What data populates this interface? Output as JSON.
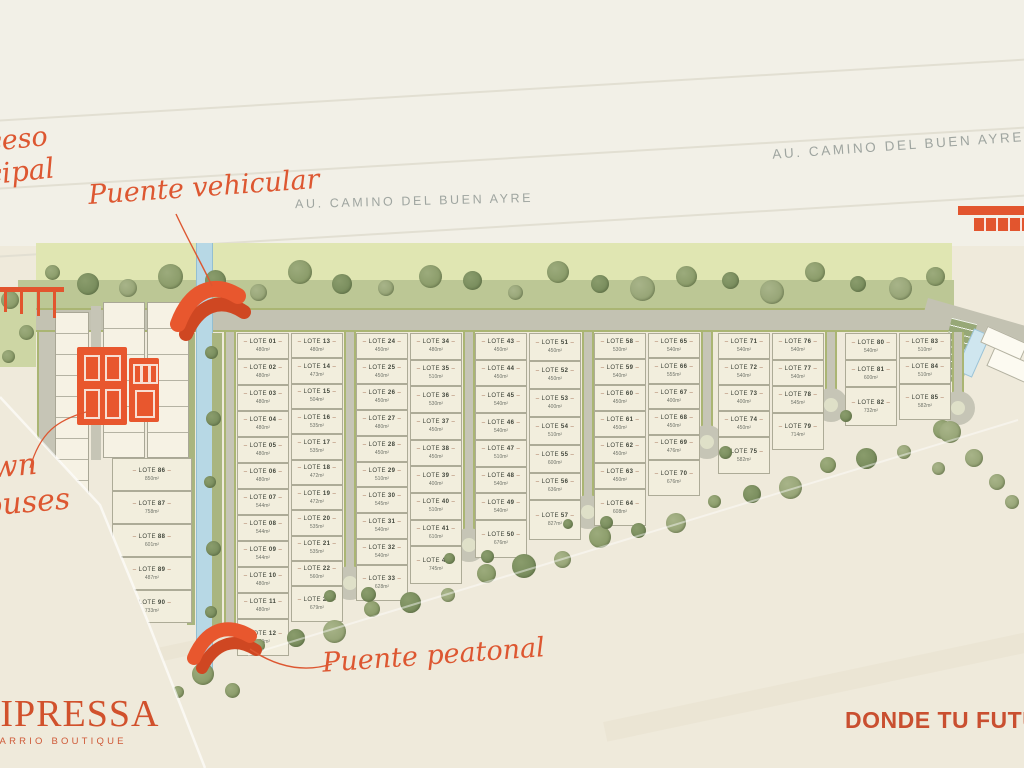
{
  "branding": {
    "logo": "CIPRESSA",
    "logo_subtitle": "BARRIO BOUTIQUE",
    "tagline": "DONDE TU FUTURO"
  },
  "labels": {
    "highway": "AU. CAMINO DEL BUEN AYRE",
    "access_line1": "Acceso",
    "access_line2": "principal",
    "vehicular_bridge": "Puente vehicular",
    "pedestrian_bridge": "Puente peatonal",
    "town_houses_line1": "town",
    "town_houses_line2": "houses"
  },
  "colors": {
    "accent_orange": "#E2552E",
    "script_orange": "#DD5731",
    "logo_orange": "#D1512C",
    "road_gray": "#C6C5B6",
    "buffer_green_light": "#E0E6B2",
    "buffer_green_dark": "#BCC795",
    "canal_blue": "#B7D8E5",
    "lot_fill": "#F2EEDD",
    "highway_text_gray": "#9FA5A0",
    "background_cream": "#EFEADB"
  },
  "lot_columns": [
    [
      {
        "id": "LOTE 01",
        "area": "480m²"
      },
      {
        "id": "LOTE 02",
        "area": "480m²"
      },
      {
        "id": "LOTE 03",
        "area": "480m²"
      },
      {
        "id": "LOTE 04",
        "area": "480m²"
      },
      {
        "id": "LOTE 05",
        "area": "480m²"
      },
      {
        "id": "LOTE 06",
        "area": "480m²"
      },
      {
        "id": "LOTE 07",
        "area": "544m²"
      },
      {
        "id": "LOTE 08",
        "area": "544m²"
      },
      {
        "id": "LOTE 09",
        "area": "544m²"
      },
      {
        "id": "LOTE 10",
        "area": "480m²"
      },
      {
        "id": "LOTE 11",
        "area": "480m²"
      },
      {
        "id": "LOTE 12",
        "area": "679m²"
      }
    ],
    [
      {
        "id": "LOTE 13",
        "area": "480m²"
      },
      {
        "id": "LOTE 14",
        "area": "473m²"
      },
      {
        "id": "LOTE 15",
        "area": "504m²"
      },
      {
        "id": "LOTE 16",
        "area": "535m²"
      },
      {
        "id": "LOTE 17",
        "area": "535m²"
      },
      {
        "id": "LOTE 18",
        "area": "472m²"
      },
      {
        "id": "LOTE 19",
        "area": "472m²"
      },
      {
        "id": "LOTE 20",
        "area": "535m²"
      },
      {
        "id": "LOTE 21",
        "area": "535m²"
      },
      {
        "id": "LOTE 22",
        "area": "560m²"
      },
      {
        "id": "LOTE 23",
        "area": "679m²"
      }
    ],
    [
      {
        "id": "LOTE 24",
        "area": "450m²"
      },
      {
        "id": "LOTE 25",
        "area": "450m²"
      },
      {
        "id": "LOTE 26",
        "area": "450m²"
      },
      {
        "id": "LOTE 27",
        "area": "480m²"
      },
      {
        "id": "LOTE 28",
        "area": "450m²"
      },
      {
        "id": "LOTE 29",
        "area": "510m²"
      },
      {
        "id": "LOTE 30",
        "area": "545m²"
      },
      {
        "id": "LOTE 31",
        "area": "540m²"
      },
      {
        "id": "LOTE 32",
        "area": "540m²"
      },
      {
        "id": "LOTE 33",
        "area": "628m²"
      }
    ],
    [
      {
        "id": "LOTE 34",
        "area": "480m²"
      },
      {
        "id": "LOTE 35",
        "area": "510m²"
      },
      {
        "id": "LOTE 36",
        "area": "530m²"
      },
      {
        "id": "LOTE 37",
        "area": "450m²"
      },
      {
        "id": "LOTE 38",
        "area": "450m²"
      },
      {
        "id": "LOTE 39",
        "area": "400m²"
      },
      {
        "id": "LOTE 40",
        "area": "510m²"
      },
      {
        "id": "LOTE 41",
        "area": "610m²"
      },
      {
        "id": "LOTE 42",
        "area": "745m²"
      }
    ],
    [
      {
        "id": "LOTE 43",
        "area": "450m²"
      },
      {
        "id": "LOTE 44",
        "area": "450m²"
      },
      {
        "id": "LOTE 45",
        "area": "540m²"
      },
      {
        "id": "LOTE 46",
        "area": "540m²"
      },
      {
        "id": "LOTE 47",
        "area": "510m²"
      },
      {
        "id": "LOTE 48",
        "area": "540m²"
      },
      {
        "id": "LOTE 49",
        "area": "540m²"
      },
      {
        "id": "LOTE 50",
        "area": "676m²"
      }
    ],
    [
      {
        "id": "LOTE 51",
        "area": "450m²"
      },
      {
        "id": "LOTE 52",
        "area": "450m²"
      },
      {
        "id": "LOTE 53",
        "area": "400m²"
      },
      {
        "id": "LOTE 54",
        "area": "510m²"
      },
      {
        "id": "LOTE 55",
        "area": "600m²"
      },
      {
        "id": "LOTE 56",
        "area": "636m²"
      },
      {
        "id": "LOTE 57",
        "area": "827m²"
      }
    ],
    [
      {
        "id": "LOTE 58",
        "area": "530m²"
      },
      {
        "id": "LOTE 59",
        "area": "540m²"
      },
      {
        "id": "LOTE 60",
        "area": "450m²"
      },
      {
        "id": "LOTE 61",
        "area": "450m²"
      },
      {
        "id": "LOTE 62",
        "area": "450m²"
      },
      {
        "id": "LOTE 63",
        "area": "450m²"
      },
      {
        "id": "LOTE 64",
        "area": "608m²"
      }
    ],
    [
      {
        "id": "LOTE 65",
        "area": "540m²"
      },
      {
        "id": "LOTE 66",
        "area": "555m²"
      },
      {
        "id": "LOTE 67",
        "area": "400m²"
      },
      {
        "id": "LOTE 68",
        "area": "450m²"
      },
      {
        "id": "LOTE 69",
        "area": "476m²"
      },
      {
        "id": "LOTE 70",
        "area": "676m²"
      }
    ],
    [
      {
        "id": "LOTE 71",
        "area": "540m²"
      },
      {
        "id": "LOTE 72",
        "area": "540m²"
      },
      {
        "id": "LOTE 73",
        "area": "400m²"
      },
      {
        "id": "LOTE 74",
        "area": "450m²"
      },
      {
        "id": "LOTE 75",
        "area": "582m²"
      }
    ],
    [
      {
        "id": "LOTE 76",
        "area": "540m²"
      },
      {
        "id": "LOTE 77",
        "area": "540m²"
      },
      {
        "id": "LOTE 78",
        "area": "545m²"
      },
      {
        "id": "LOTE 79",
        "area": "714m²"
      }
    ],
    [
      {
        "id": "LOTE 80",
        "area": "540m²"
      },
      {
        "id": "LOTE 81",
        "area": "600m²"
      },
      {
        "id": "LOTE 82",
        "area": "732m²"
      }
    ],
    [
      {
        "id": "LOTE 83",
        "area": "510m²"
      },
      {
        "id": "LOTE 84",
        "area": "510m²"
      },
      {
        "id": "LOTE 85",
        "area": "582m²"
      }
    ]
  ],
  "town_lots": [
    {
      "id": "LOTE 86",
      "area": "850m²"
    },
    {
      "id": "LOTE 87",
      "area": "758m²"
    },
    {
      "id": "LOTE 88",
      "area": "601m²"
    },
    {
      "id": "LOTE 89",
      "area": "487m²"
    },
    {
      "id": "LOTE 90",
      "area": "733m²"
    }
  ]
}
